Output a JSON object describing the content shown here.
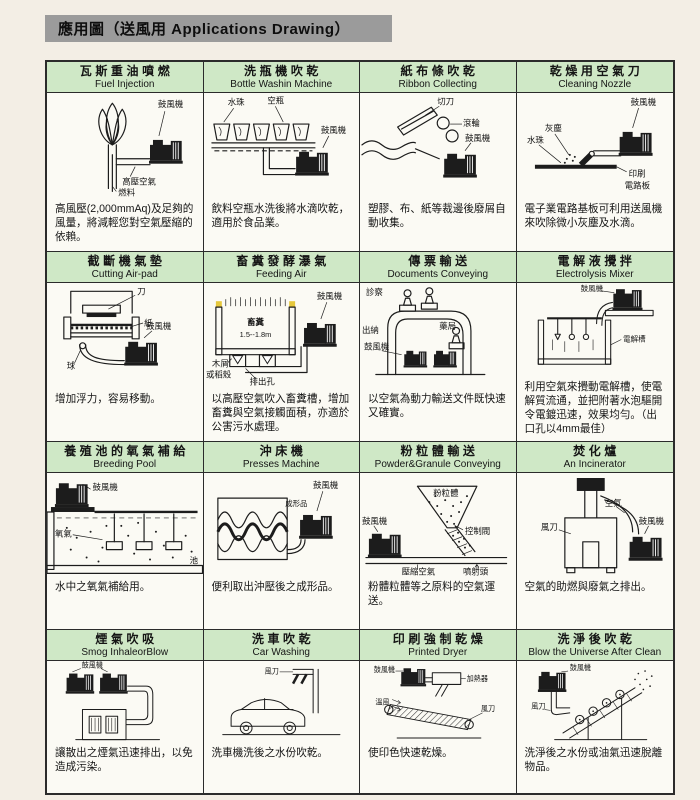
{
  "header": {
    "title": "應用圖（送風用 Applications Drawing）"
  },
  "cells": [
    {
      "zh": "瓦斯重油噴燃",
      "en": "Fuel Injection",
      "desc": "高風壓(2,000mmAq)及足夠的風量，將減輕您對空氣壓縮的依賴。",
      "labels": [
        "鼓風機",
        "高壓空氣",
        "燃料"
      ]
    },
    {
      "zh": "洗瓶機吹乾",
      "en": "Bottle Washin Machine",
      "desc": "飲料空瓶水洗後將水滴吹乾，適用於食品業。",
      "labels": [
        "水珠",
        "空瓶",
        "鼓風機"
      ]
    },
    {
      "zh": "紙布條吹乾",
      "en": "Ribbon Collecting",
      "desc": "塑膠、布、紙等裁邊後廢屑自動收集。",
      "labels": [
        "切刀",
        "滾輪",
        "鼓風機"
      ]
    },
    {
      "zh": "乾燥用空氣刀",
      "en": "Cleaning Nozzle",
      "desc": "電子業電路基板可利用送風機來吹除微小灰塵及水滴。",
      "labels": [
        "鼓風機",
        "灰塵",
        "水珠",
        "印刷",
        "電路板"
      ]
    },
    {
      "zh": "截斷機氣墊",
      "en": "Cutting Air-pad",
      "desc": "增加浮力，容易移動。",
      "labels": [
        "刀",
        "紙",
        "球",
        "鼓風機"
      ]
    },
    {
      "zh": "畜糞發酵瀑氣",
      "en": "Feeding Air",
      "desc": "以高壓空氣吹入畜糞槽，增加畜糞與空氣接觸面積，亦適於公害污水處理。",
      "labels": [
        "畜糞",
        "1.5--1.8m",
        "鼓風機",
        "木屑",
        "或稻殼",
        "排出孔"
      ]
    },
    {
      "zh": "傳票輸送",
      "en": "Documents Conveying",
      "desc": "以空氣為動力輸送文件既快速又確實。",
      "labels": [
        "診察",
        "出納",
        "藥局",
        "鼓風機"
      ]
    },
    {
      "zh": "電解液攪拌",
      "en": "Electrolysis Mixer",
      "desc": "利用空氣來攪動電解槽，使電解質流通，並把附著水泡驅開令電鍍迅速，效果均勻。（出口孔以4mm最佳）",
      "labels": [
        "鼓風機",
        "電解槽"
      ]
    },
    {
      "zh": "養殖池的氧氣補給",
      "en": "Breeding Pool",
      "desc": "水中之氧氣補給用。",
      "labels": [
        "鼓風機",
        "氧氣",
        "池"
      ]
    },
    {
      "zh": "沖床機",
      "en": "Presses Machine",
      "desc": "便利取出沖壓後之成形品。",
      "labels": [
        "成形品",
        "鼓風機"
      ]
    },
    {
      "zh": "粉粒體輸送",
      "en": "Powder&Granule Conveying",
      "desc": "粉體粒體等之原料的空氣運送。",
      "labels": [
        "粉粒體",
        "控制閥",
        "鼓風機",
        "壓縮空氣",
        "噴射頭"
      ]
    },
    {
      "zh": "焚化爐",
      "en": "An Incinerator",
      "desc": "空氣的助燃與廢氣之排出。",
      "labels": [
        "空氣",
        "鼓風機",
        "風刀"
      ]
    },
    {
      "zh": "煙氣吹吸",
      "en": "Smog InhaleorBlow",
      "desc": "讓散出之煙氣迅速排出，以免造成污染。",
      "labels": [
        "鼓風機"
      ]
    },
    {
      "zh": "洗車吹乾",
      "en": "Car Washing",
      "desc": "洗車機洗後之水份吹乾。",
      "labels": [
        "風刀"
      ]
    },
    {
      "zh": "印刷強制乾燥",
      "en": "Printed Dryer",
      "desc": "使印色快速乾燥。",
      "labels": [
        "鼓風機",
        "加熱器",
        "溫風",
        "風刀"
      ]
    },
    {
      "zh": "洗淨後吹乾",
      "en": "Blow the Universe After Clean",
      "desc": "洗淨後之水份或油氣迅速脫離物品。",
      "labels": [
        "鼓風機",
        "風刀"
      ]
    }
  ]
}
